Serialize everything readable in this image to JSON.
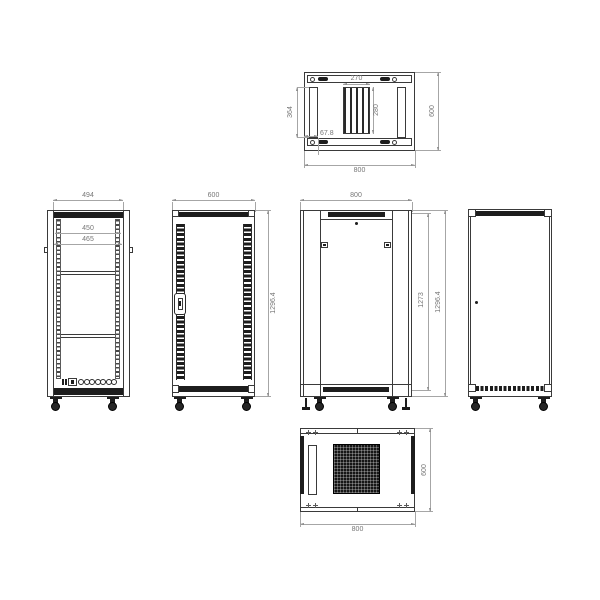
{
  "drawing": {
    "type": "technical-orthographic-drawing",
    "subject": "network server rack cabinet",
    "views": {
      "top": {
        "label": "top view",
        "dims": {
          "width": "800",
          "depth": "600",
          "slot_length": "364",
          "slot_offset": "67.8",
          "vent_width": "270",
          "vent_depth": "280"
        }
      },
      "front_frame": {
        "label": "front frame view",
        "dims": {
          "frame_width": "494",
          "opening_width": "450",
          "rail_width": "465"
        }
      },
      "side_vented": {
        "label": "side view vented",
        "dims": {
          "depth": "600",
          "height": "1296.4"
        }
      },
      "front_door": {
        "label": "front door view",
        "dims": {
          "width": "800",
          "door_height": "1273",
          "height": "1296.4"
        }
      },
      "side_panel": {
        "label": "side panel view",
        "dims": {}
      },
      "bottom": {
        "label": "bottom view",
        "dims": {
          "width": "800",
          "depth": "600"
        }
      }
    },
    "colors": {
      "background": "#ffffff",
      "line": "#3a3a3a",
      "dim_line": "#a6a6a6",
      "dim_text": "#767676",
      "fill_dark": "#1d1d1d"
    }
  }
}
